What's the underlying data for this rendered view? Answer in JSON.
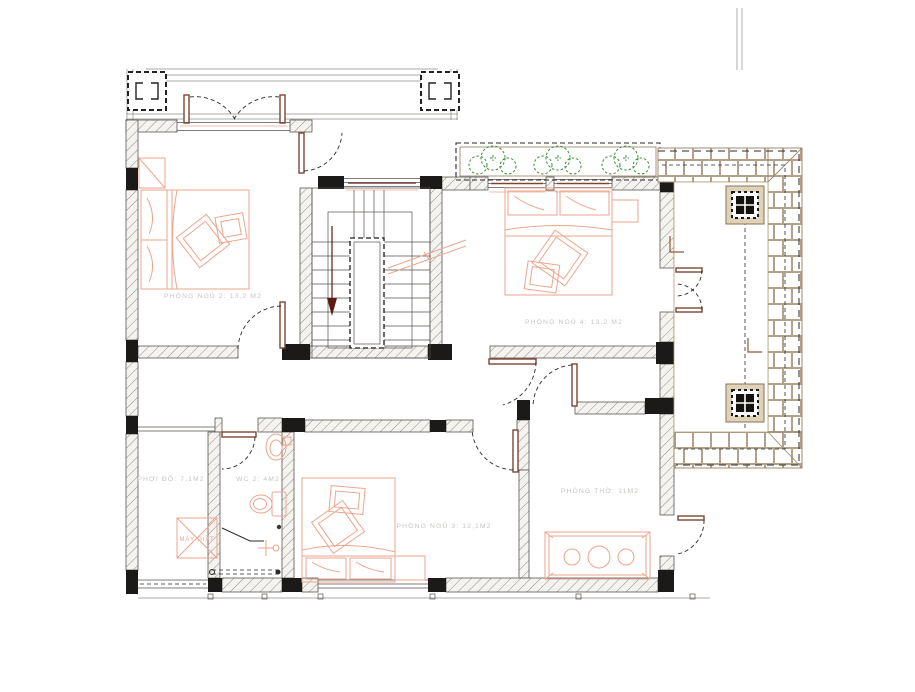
{
  "drawing": {
    "type": "architectural-floor-plan",
    "labels": {
      "bedroom2": "PHÒNG NGỦ 2: 13,2 M2",
      "bedroom4": "PHÒNG NGỦ 4: 13,2 M2",
      "bedroom3": "PHÒNG NGỦ 3: 12,1M2",
      "worship": "PHÒNG THỜ: 11M2",
      "laundry": "PHƠI ĐỒ: 7,1M2",
      "wc": "WC 2: 4M2",
      "washer": "MÁY GIẶT"
    },
    "colors": {
      "furniture_outline": "#eda68e",
      "door_leaf": "#7d4434",
      "tree_green": "#3c8f3c",
      "wall_hatch": "#8f8d89",
      "wall_column_black": "#1c1a18",
      "roof_tile": "#a08a6d",
      "label_gray": "#c7c5c1",
      "stair_arrow": "#5e1a10"
    },
    "icons": {
      "stair_down_arrow": "walking-line-down-arrow",
      "washer_symbol": "x-crossed-box",
      "trees": "shrub-circles"
    }
  }
}
